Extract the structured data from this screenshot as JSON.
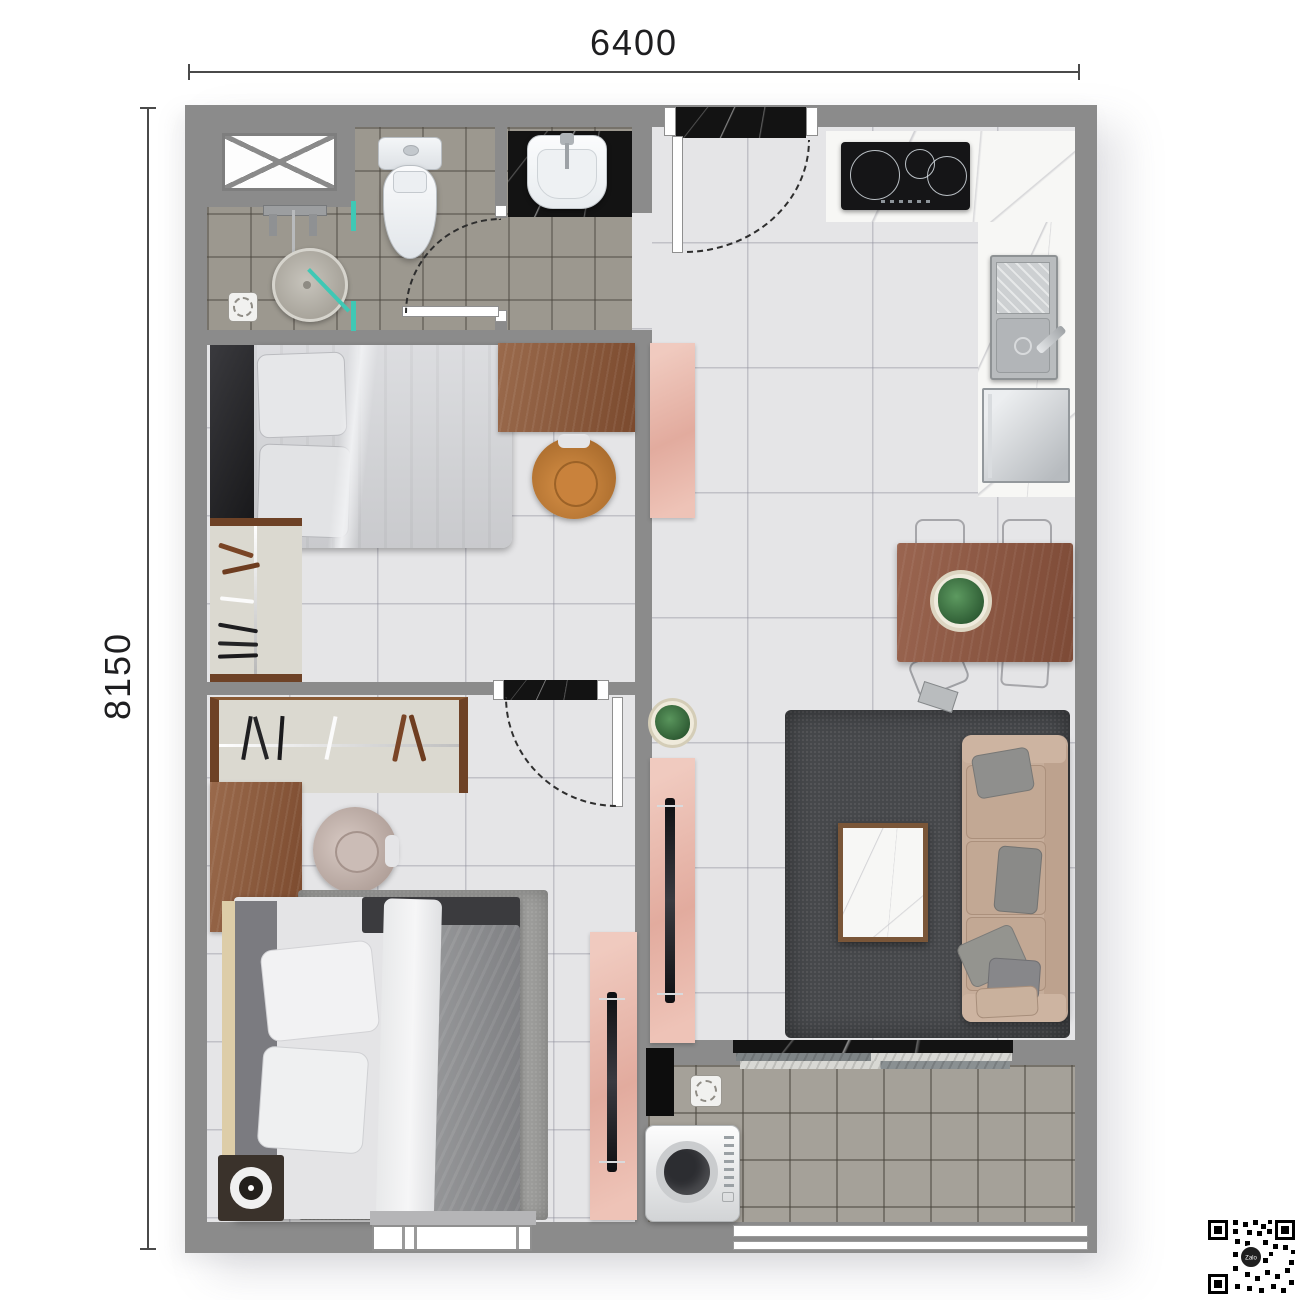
{
  "dimensions": {
    "top": "6400",
    "left": "8150"
  },
  "qr": {
    "label": "Zalo"
  },
  "palette": {
    "wall": "#8b8b8b",
    "floor_light": "#e5e5e7",
    "floor_bath": "#9c988f",
    "floor_balcony": "#a5a199",
    "marble_black": "#131313",
    "marble_white": "#f7f7f5",
    "wood": "#8a5a3a",
    "wood_dark": "#6e4226",
    "pink_cabinet": "#e8b7ad",
    "teal_glass": "#3fc8b5",
    "rug_living": "#46484b",
    "rug_bedroom": "#9d9d9b",
    "sofa_beige": "#c6ad9a",
    "pillow_gray": "#8f8f8d",
    "chair_leather": "#c5813d",
    "dimension_line": "#4a4a4a"
  }
}
